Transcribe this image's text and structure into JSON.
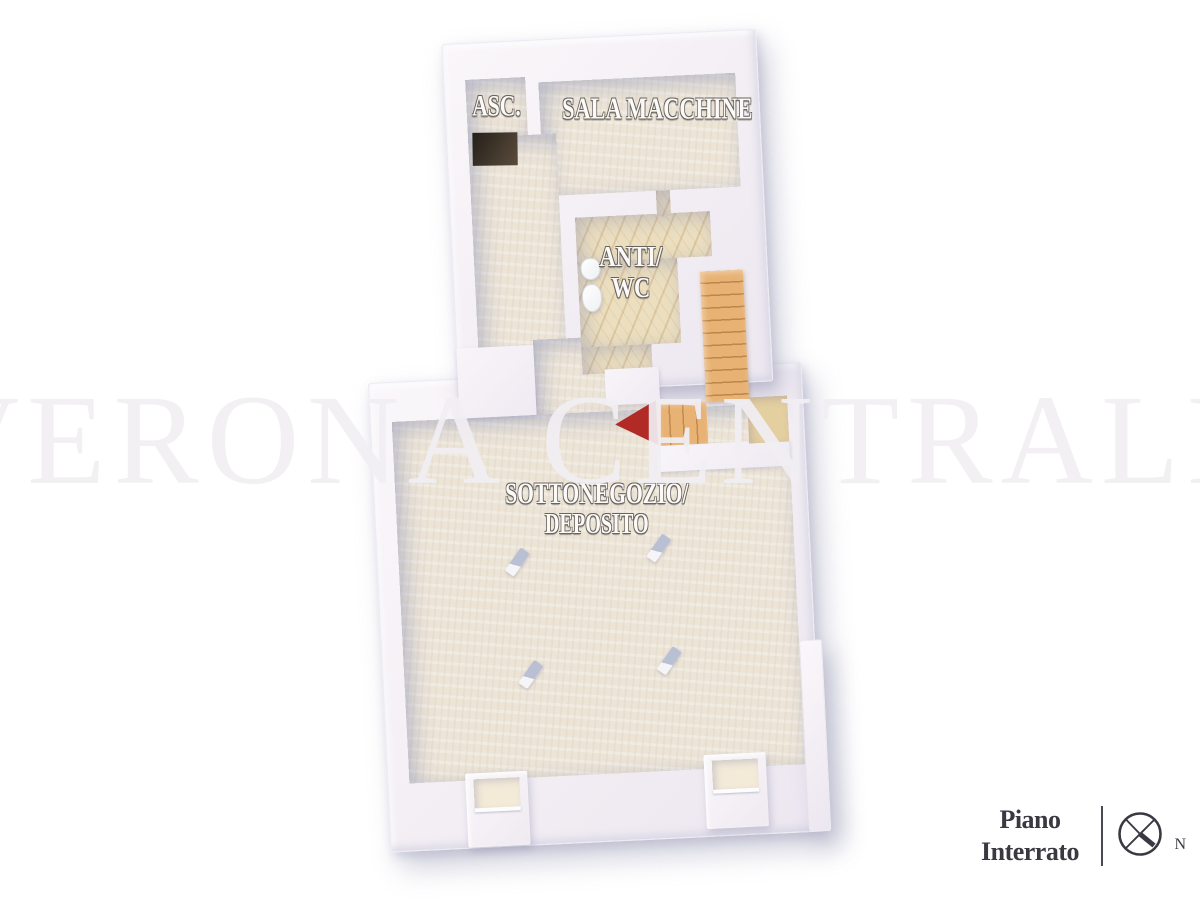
{
  "watermark_text": "VERONA CENTRALE",
  "plan": {
    "rooms": [
      {
        "name": "ascensore",
        "label": "ASC."
      },
      {
        "name": "sala-macchine",
        "label": "SALA MACCHINE"
      },
      {
        "name": "anti-wc",
        "label_lines": [
          "ANTI/",
          "WC"
        ]
      },
      {
        "name": "sottonegozio-deposito",
        "label_lines": [
          "SOTTONEGOZIO/",
          "DEPOSITO"
        ]
      }
    ],
    "features": [
      "staircase",
      "direction-arrow",
      "elevator-shaft",
      "window-wells",
      "columns"
    ]
  },
  "legend": {
    "floor_label_lines": [
      "Piano",
      "Interrato"
    ],
    "compass_north": "N"
  },
  "colors": {
    "arrow_red": "#b12a26",
    "stair_wood": "#e8b274",
    "floor_beige": "#ece4d7",
    "marble": "#ecdfc0",
    "wall_white": "#f7f3f7",
    "legend_ink": "#3a3942",
    "watermark": "#f2eff4"
  }
}
